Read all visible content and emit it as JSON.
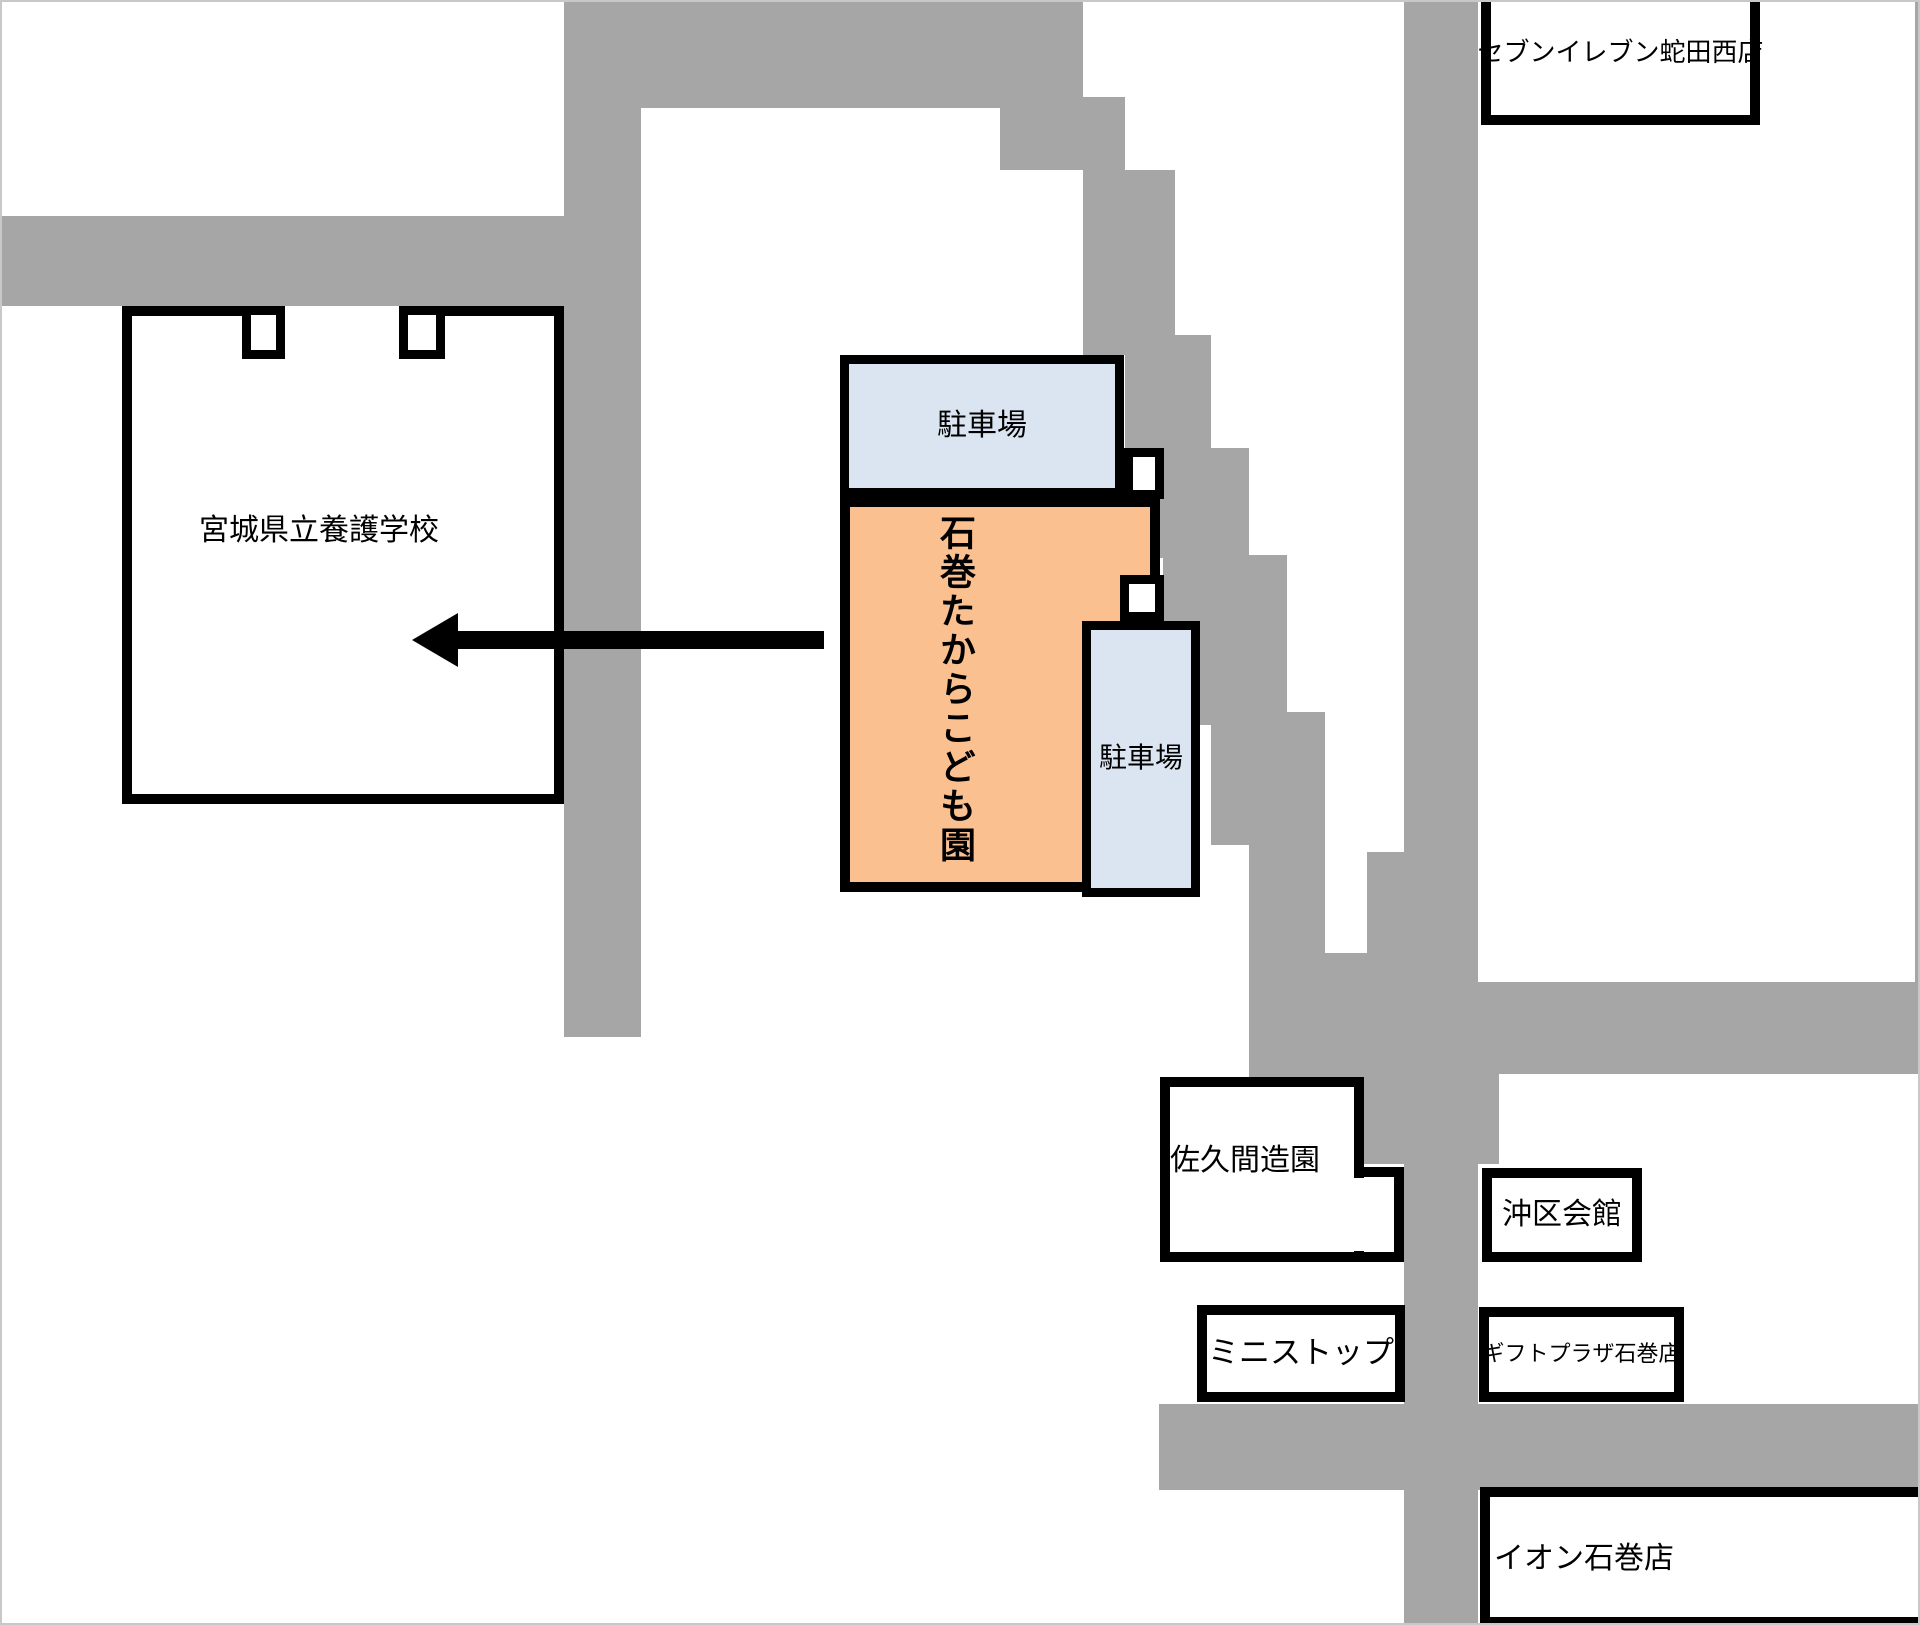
{
  "map": {
    "background_color": "#ffffff",
    "road_color": "#a6a6a6",
    "outline_color": "#000000",
    "parking_fill": "#dbe5f1",
    "facility_fill": "#fac090",
    "arrow": {
      "direction": "left",
      "color": "#000000"
    },
    "buildings": {
      "seven_eleven": {
        "label": "セブンイレブン蛇田西店"
      },
      "school": {
        "label": "宮城県立養護学校"
      },
      "parking_top": {
        "label": "駐車場"
      },
      "facility": {
        "label": "石巻たからこども園"
      },
      "parking_side": {
        "label": "駐車場"
      },
      "sakuma": {
        "label": "佐久間造園"
      },
      "oki_hall": {
        "label": "沖区会館"
      },
      "ministop": {
        "label": "ミニストップ"
      },
      "gift_plaza": {
        "label": "ギフトプラザ石巻店"
      },
      "aeon": {
        "label": "イオン石巻店"
      }
    }
  }
}
